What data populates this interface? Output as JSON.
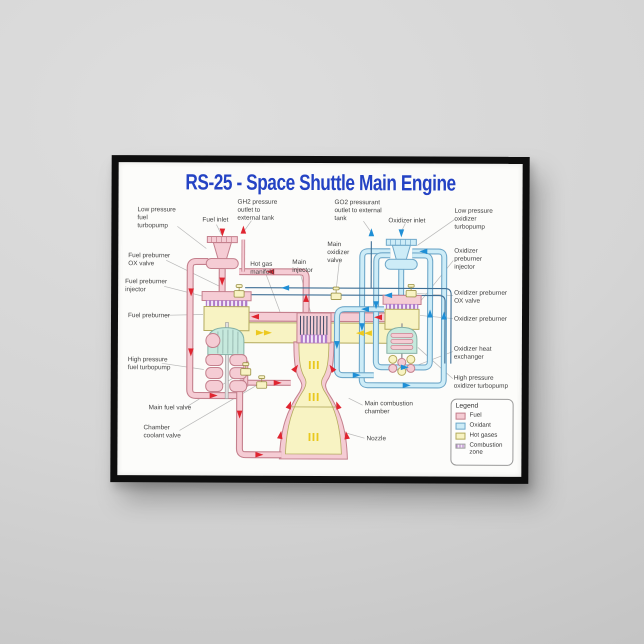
{
  "poster": {
    "title": "RS-25 - Space Shuttle Main Engine",
    "title_color": "#2443c4"
  },
  "diagram_labels": {
    "low_pressure_fuel_turbopump": "Low pressure fuel turbopump",
    "fuel_inlet": "Fuel inlet",
    "gh2_outlet": "GH2 pressure outlet to external tank",
    "go2_outlet": "GO2 pressurant outlet to external tank",
    "oxidizer_inlet": "Oxidizer inlet",
    "low_pressure_oxidizer_turbopump": "Low pressure oxidizer turbopump",
    "fuel_preburner_ox_valve": "Fuel preburner OX valve",
    "fuel_preburner_injector": "Fuel preburner injector",
    "fuel_preburner": "Fuel preburner",
    "high_pressure_fuel_turbopump": "High pressure fuel turbopump",
    "main_fuel_valve": "Main fuel valve",
    "chamber_coolant_valve": "Chamber coolant valve",
    "main_oxidizer_valve": "Main oxidizer valve",
    "hot_gas_manifold": "Hot gas manifold",
    "main_injector": "Main injector",
    "oxidizer_preburner_injector": "Oxidizer preburner injector",
    "oxidizer_preburner_ox_valve": "Oxidizer preburner OX valve",
    "oxidizer_preburner": "Oxidizer preburner",
    "oxidizer_heat_exchanger": "Oxidizer heat exchanger",
    "high_pressure_oxidizer_turbopump": "High pressure oxidizer turbopump",
    "main_combustion_chamber": "Main combustion chamber",
    "nozzle": "Nozzle"
  },
  "legend": {
    "title": "Legend",
    "items": [
      {
        "label": "Fuel",
        "color": "#f5ccd4"
      },
      {
        "label": "Oxidant",
        "color": "#cdecf7"
      },
      {
        "label": "Hot gases",
        "color": "#f8f3c3"
      },
      {
        "label": "Combustion zone",
        "color": "#b07cc8"
      }
    ]
  },
  "colors": {
    "fuel_pipe": "#f5ccd4",
    "fuel_pipe_outline": "#c4808d",
    "oxidant_pipe": "#cdecf7",
    "oxidant_pipe_outline": "#6fa8c9",
    "hot_gas": "#f8f3c3",
    "combustion_zone": "#b07cc8",
    "fuel_flow_arrow": "#e02530",
    "oxidant_flow_arrow": "#1f8fd6",
    "hot_gas_arrow": "#edc91f",
    "frame": "#0e0e0e",
    "wall": "#d3d3d3",
    "poster_bg": "#fcfcfa"
  }
}
